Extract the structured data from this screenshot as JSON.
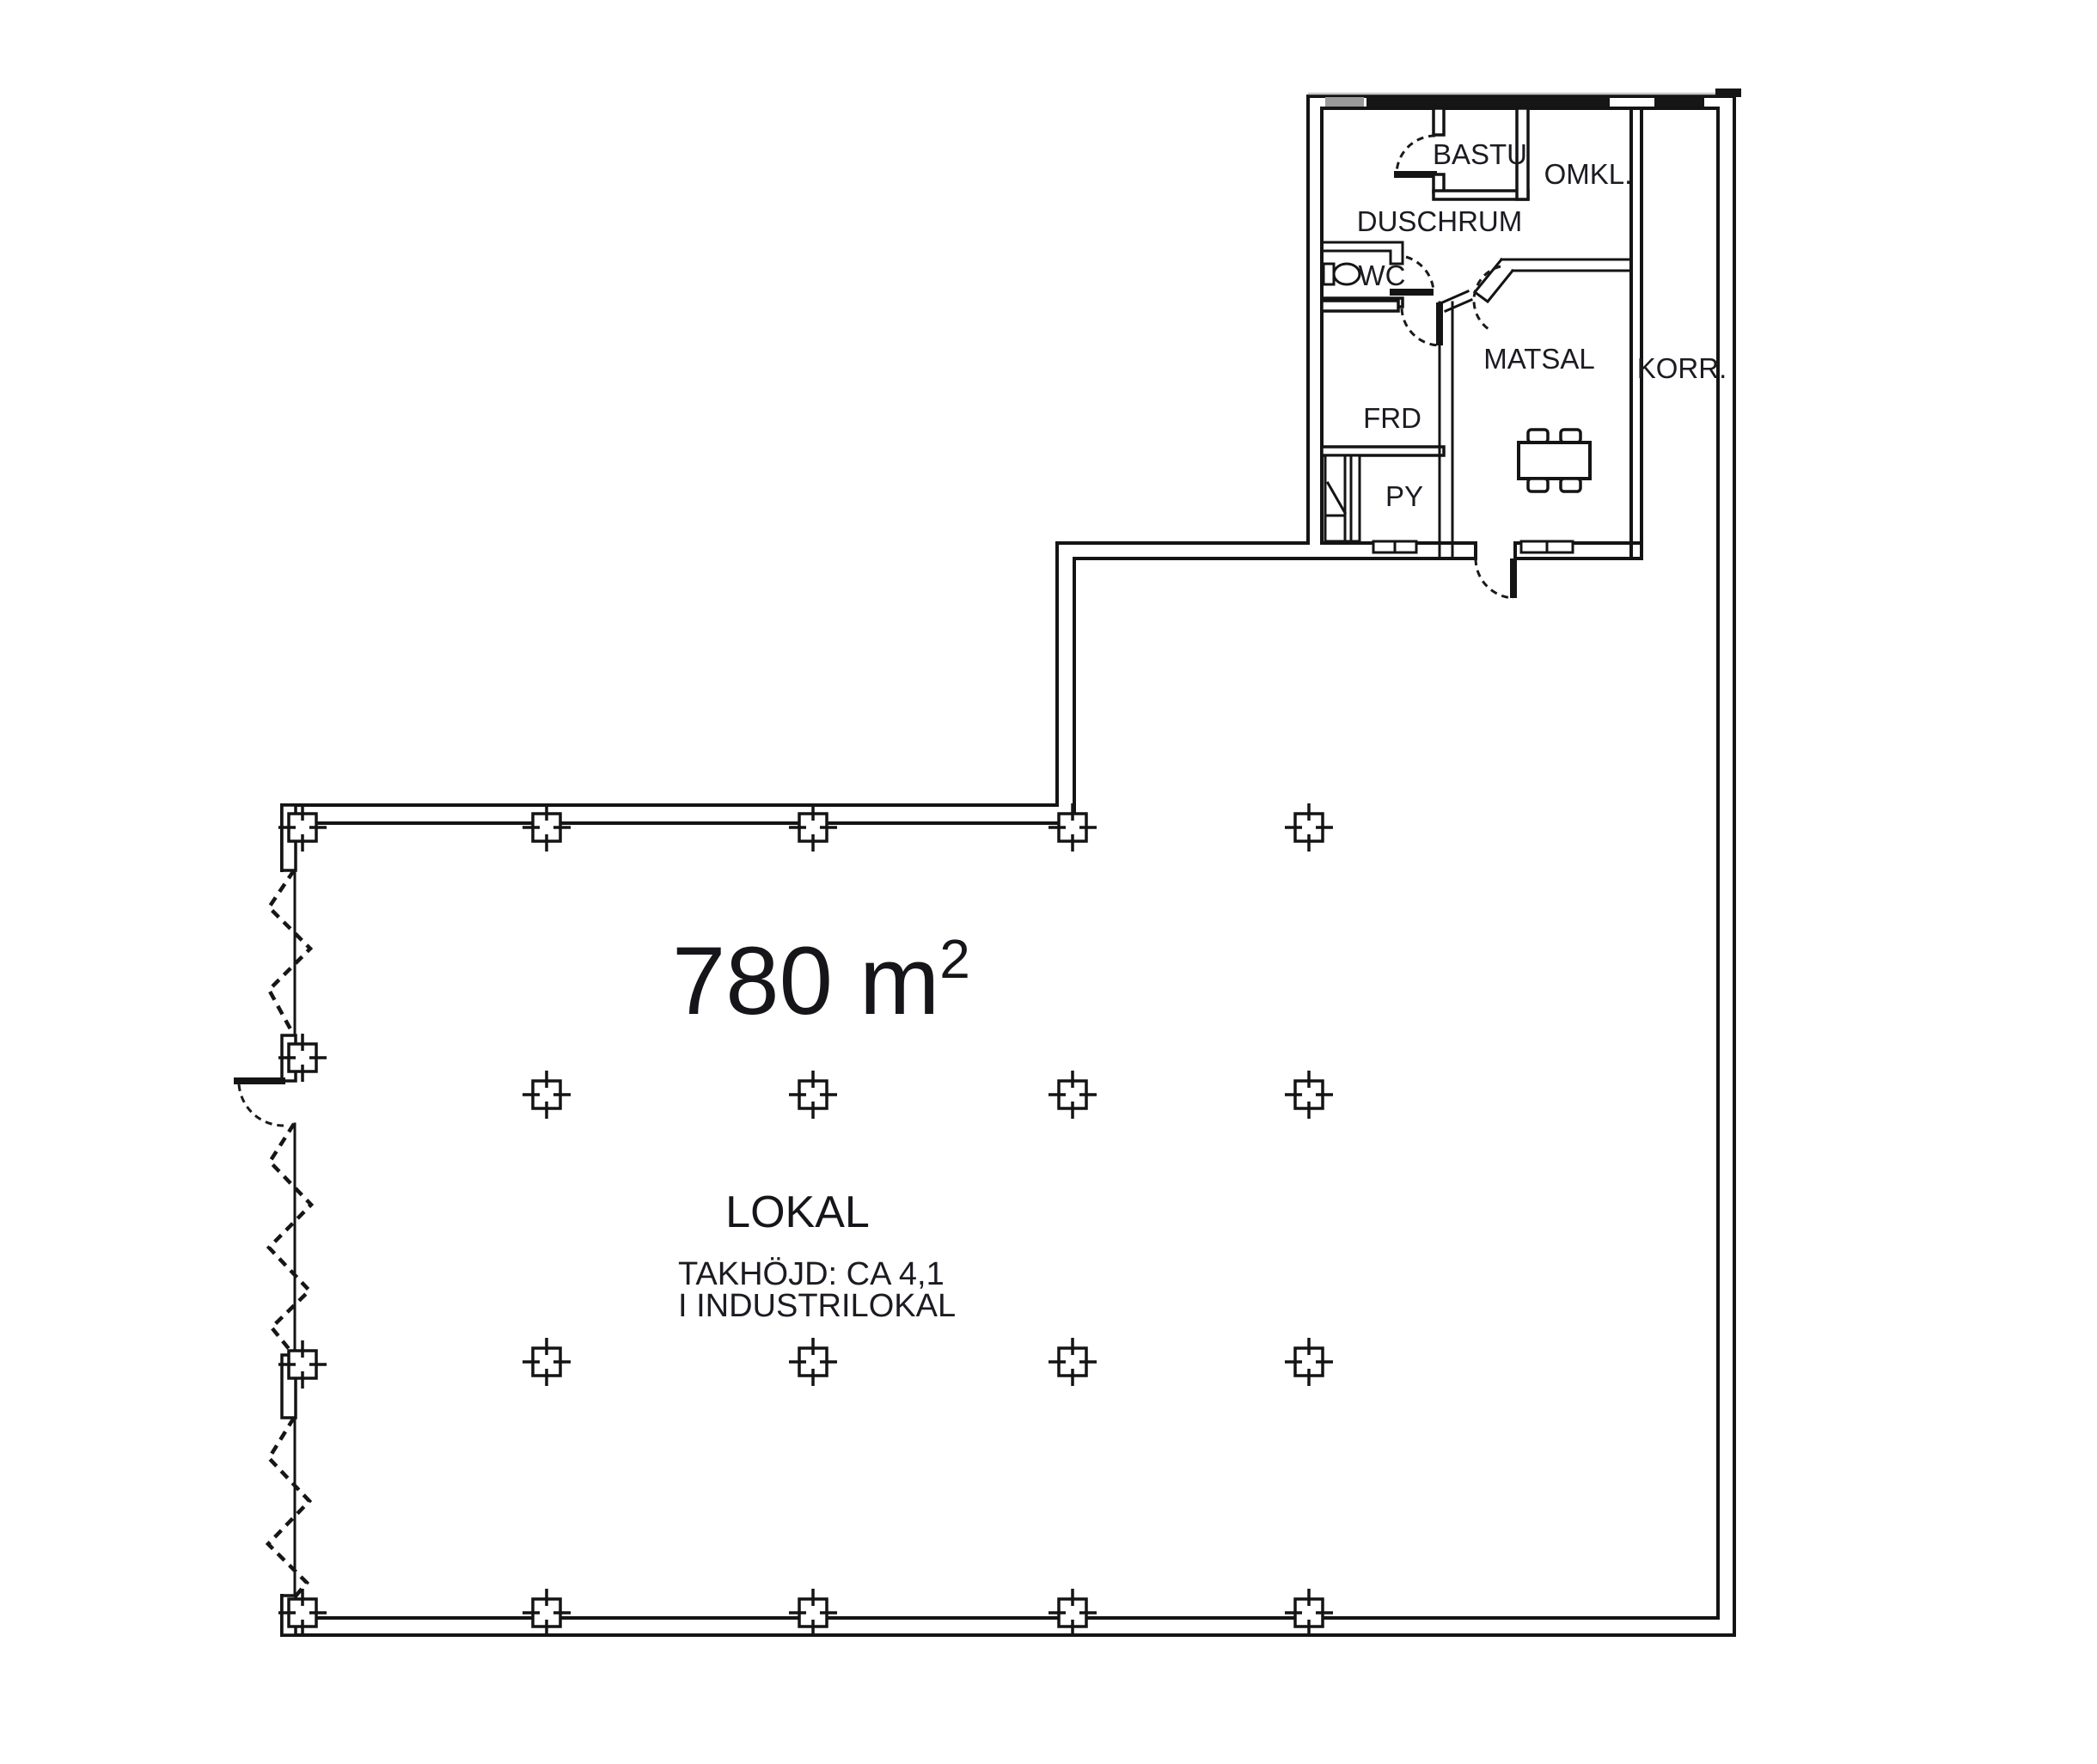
{
  "drawing": {
    "area": {
      "value": "780 m",
      "superscript": "2"
    },
    "hall": {
      "name": "LOKAL",
      "note_line1": "TAKHÖJD: CA 4,1",
      "note_line2": "I INDUSTRILOKAL"
    },
    "rooms": {
      "bastu": {
        "label": "BASTU"
      },
      "omkl": {
        "label": "OMKL."
      },
      "duschrum": {
        "label": "DUSCHRUM"
      },
      "wc": {
        "label": "WC"
      },
      "frd": {
        "label": "FRD"
      },
      "matsal": {
        "label": "MATSAL"
      },
      "korr": {
        "label": "KORR."
      },
      "py": {
        "label": "PY"
      }
    },
    "colors": {
      "line": "#141414",
      "background": "#ffffff",
      "text": "#1b1b22"
    }
  }
}
